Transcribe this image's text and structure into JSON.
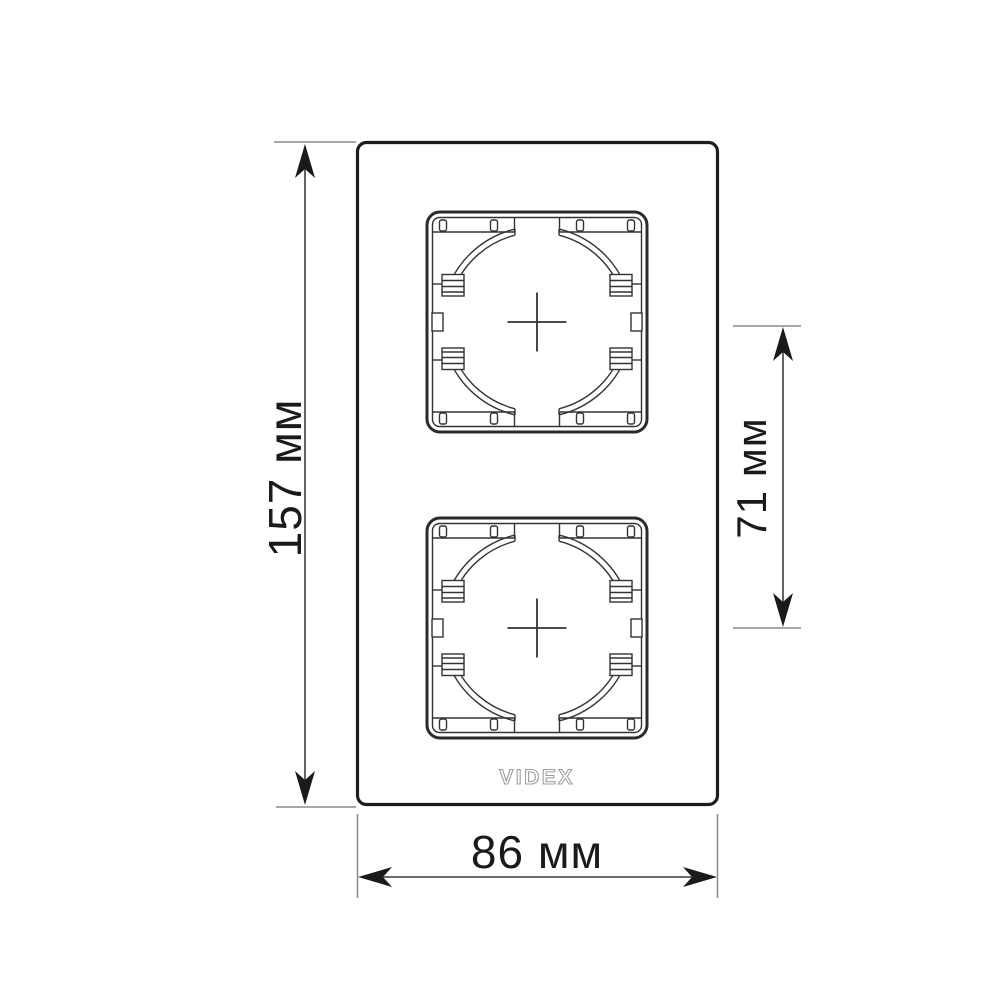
{
  "diagram": {
    "kind": "technical-dimension-drawing",
    "subject": "double-vertical-wall-frame",
    "sockets_count": 2
  },
  "frame": {
    "logo": "VIDEX"
  },
  "dimensions": {
    "height": {
      "label": "157 мм",
      "value": 157,
      "unit": "мм"
    },
    "width": {
      "label": "86 мм",
      "value": 86,
      "unit": "мм"
    },
    "spacing": {
      "label": "71 мм",
      "value": 71,
      "unit": "мм"
    }
  },
  "colors": {
    "background": "#ffffff",
    "frame_line": "#1d1d1d",
    "socket_line": "#333333",
    "dimension_line": "#3c3c3c",
    "extension_line": "#8a8a8a",
    "arrow": "#1a1a1a",
    "text": "#1a1a1a",
    "logo": "#9e9e9e"
  }
}
